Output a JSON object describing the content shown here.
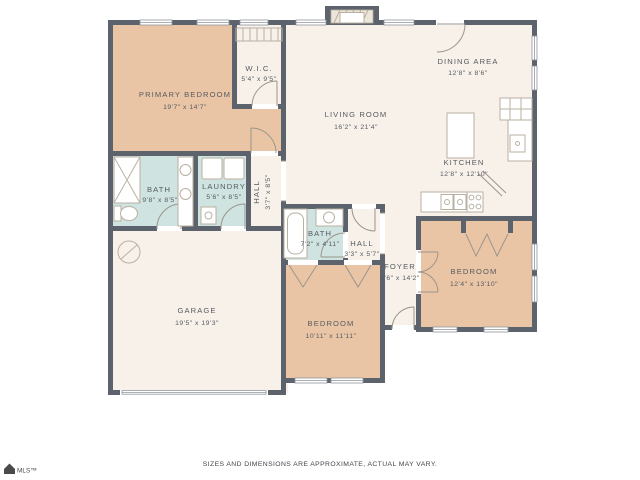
{
  "document": {
    "disclaimer": "SIZES AND DIMENSIONS ARE APPROXIMATE, ACTUAL MAY VARY.",
    "logo_text": "MLS™"
  },
  "colors": {
    "wall": "#5d636c",
    "bedroom_fill": "#eac5a5",
    "bath_fill": "#cfe3e0",
    "common_fill": "#f8f1ea",
    "label_text": "#565b63",
    "fixture_stroke": "#b9b0a2",
    "door_stroke": "#9a958c",
    "window_stroke": "#8f959c"
  },
  "rooms": {
    "primary_bedroom": {
      "name": "PRIMARY BEDROOM",
      "dims": "19'7\" x 14'7\""
    },
    "wic": {
      "name": "W.I.C.",
      "dims": "5'4\" x 9'5\""
    },
    "living_room": {
      "name": "LIVING ROOM",
      "dims": "16'2\" x 21'4\""
    },
    "dining_area": {
      "name": "DINING AREA",
      "dims": "12'8\" x 8'6\""
    },
    "kitchen": {
      "name": "KITCHEN",
      "dims": "12'8\" x 12'10\""
    },
    "bath_primary": {
      "name": "BATH",
      "dims": "9'8\" x 8'5\""
    },
    "laundry": {
      "name": "LAUNDRY",
      "dims": "5'6\" x 8'5\""
    },
    "hall_bedroom": {
      "name": "HALL",
      "dims": "3'7\" x 8'5\""
    },
    "bath_2": {
      "name": "BATH",
      "dims": "7'2\" x 4'11\""
    },
    "hall_foyer": {
      "name": "HALL",
      "dims": "3'3\" x 5'7\""
    },
    "foyer": {
      "name": "FOYER",
      "dims": "4'6\" x 14'2\""
    },
    "bedroom_2": {
      "name": "BEDROOM",
      "dims": "12'4\" x 13'10\""
    },
    "bedroom_3": {
      "name": "BEDROOM",
      "dims": "10'11\" x 11'11\""
    },
    "garage": {
      "name": "GARAGE",
      "dims": "19'5\" x 19'3\""
    }
  },
  "symbols": [
    "fireplace",
    "shower",
    "toilet",
    "double-vanity-sinks",
    "washer-dryer",
    "utility-sink",
    "bathtub",
    "vanity-sink",
    "kitchen-island",
    "range-burners",
    "kitchen-double-sink",
    "counter",
    "pantry-door",
    "closet-bifold-doors",
    "door-swings",
    "windows",
    "garage-door",
    "utility-circle-symbol",
    "wic-shelf"
  ]
}
